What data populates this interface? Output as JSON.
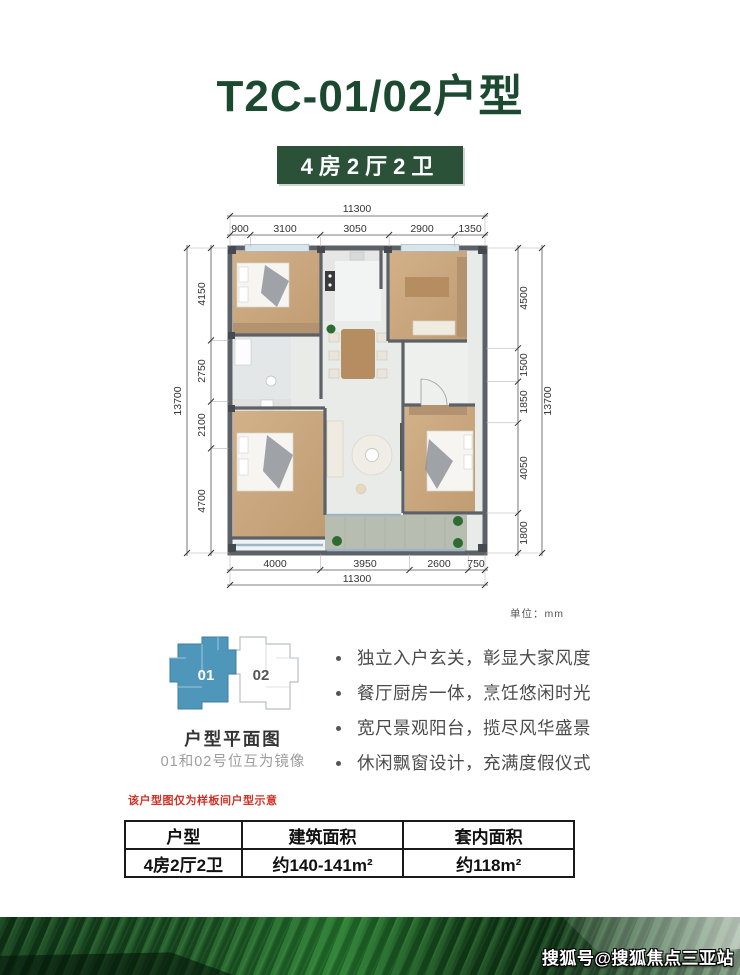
{
  "page": {
    "title": "T2C-01/02户型",
    "badge": "4房2厅2卫",
    "watermark": "搜狐号@搜狐焦点三亚站"
  },
  "plan": {
    "unit_note": "单位：mm",
    "dims": {
      "top_total": "11300",
      "top": [
        "900",
        "3100",
        "3050",
        "2900",
        "1350"
      ],
      "bottom": [
        "4000",
        "3950",
        "2600",
        "750"
      ],
      "bottom_total": "11300",
      "left": [
        "4150",
        "2750",
        "2100",
        "4700"
      ],
      "left_total": "13700",
      "right": [
        "4500",
        "1500",
        "1850",
        "4050",
        "1800"
      ],
      "right_total": "13700"
    }
  },
  "key_diagram": {
    "unit01_label": "01",
    "unit02_label": "02",
    "caption": "户型平面图",
    "note": "01和02号位互为镜像"
  },
  "features": [
    "独立入户玄关，彰显大家风度",
    "餐厅厨房一体，烹饪悠闲时光",
    "宽尺景观阳台，揽尽风华盛景",
    "休闲飘窗设计，充满度假仪式"
  ],
  "disclaimer": "该户型图仅为样板间户型示意",
  "table": {
    "headers": [
      "户型",
      "建筑面积",
      "套内面积"
    ],
    "row": [
      "4房2厅2卫",
      "约140-141m²",
      "约118m²"
    ]
  },
  "colors": {
    "title_green": "#1c4a31",
    "badge_green": "#2b5239",
    "unit_blue": "#4e97bb",
    "disclaimer_red": "#d43026",
    "wall_gray": "#5c6168",
    "wood": "#cbaa80"
  }
}
